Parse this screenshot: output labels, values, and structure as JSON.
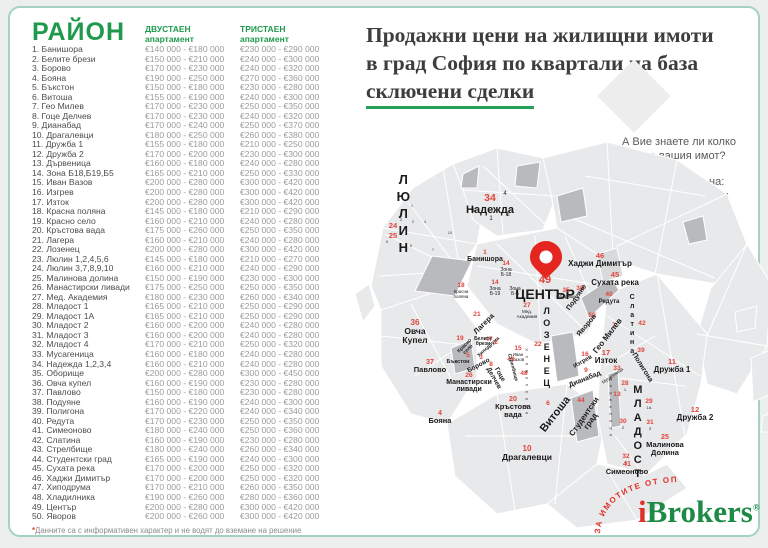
{
  "header": {
    "title_line1": "Продажни цени на жилищни имоти",
    "title_line2": "в град София по квартали на база",
    "title_line3": "сключени сделки"
  },
  "promo": {
    "line1": "А Вие знаете ли колко",
    "line2": "струва вашия имот?",
    "line3": "Разберете СЕГА на:",
    "email": "popitai@ibrokers.bg"
  },
  "table": {
    "header": {
      "district": "РАЙОН",
      "col2_line1": "ДВУСТАЕН",
      "col2_line2": "апартамент",
      "col3_line1": "ТРИСТАЕН",
      "col3_line2": "апартамент"
    },
    "rows": [
      [
        "1. Банишора",
        "€140 000 - €180 000",
        "€230 000 - €290 000"
      ],
      [
        "2. Белите брези",
        "€150 000 - €210 000",
        "€240 000 - €300 000"
      ],
      [
        "3. Борово",
        "€170 000 - €230 000",
        "€240 000 - €320 000"
      ],
      [
        "4. Бояна",
        "€190 000 - €250 000",
        "€270 000 - €360 000"
      ],
      [
        "5. Бъкстон",
        "€150 000 - €180 000",
        "€230 000 - €280 000"
      ],
      [
        "6. Витоша",
        "€155 000 - €190 000",
        "€240 000 - €300 000"
      ],
      [
        "7. Гео Милев",
        "€170 000 - €230 000",
        "€250 000 - €350 000"
      ],
      [
        "8. Гоце Делчев",
        "€170 000 - €230 000",
        "€240 000 - €320 000"
      ],
      [
        "9. Дианабад",
        "€170 000 - €240 000",
        "€250 000 - €370 000"
      ],
      [
        "10. Драгалевци",
        "€180 000 - €250 000",
        "€260 000 - €380 000"
      ],
      [
        "11. Дружба 1",
        "€155 000 - €180 000",
        "€210 000 - €250 000"
      ],
      [
        "12. Дружба 2",
        "€170 000 - €200 000",
        "€230 000 - €300 000"
      ],
      [
        "13. Дървеница",
        "€160 000 - €180 000",
        "€240 000 - €280 000"
      ],
      [
        "14. Зона Б18,Б19,Б5",
        "€165 000 - €210 000",
        "€250 000 - €330 000"
      ],
      [
        "15. Иван Вазов",
        "€200 000 - €280 000",
        "€300 000 - €420 000"
      ],
      [
        "16. Изгрев",
        "€200 000 - €280 000",
        "€300 000 - €420 000"
      ],
      [
        "17. Изток",
        "€200 000 - €280 000",
        "€300 000 - €420 000"
      ],
      [
        "18. Красна поляна",
        "€145 000 - €180 000",
        "€210 000 - €290 000"
      ],
      [
        "19. Красно село",
        "€160 000 - €210 000",
        "€240 000 - €280 000"
      ],
      [
        "20. Кръстова вада",
        "€175 000 - €260 000",
        "€250 000 - €350 000"
      ],
      [
        "21. Лагера",
        "€160 000 - €210 000",
        "€240 000 - €280 000"
      ],
      [
        "22. Лозенец",
        "€200 000 - €280 000",
        "€300 000 - €420 000"
      ],
      [
        "23. Люлин 1,2,4,5,6",
        "€145 000 - €180 000",
        "€210 000 - €270 000"
      ],
      [
        "24. Люлин 3,7,8,9,10",
        "€160 000 - €210 000",
        "€240 000 - €290 000"
      ],
      [
        "25. Малинова долина",
        "€150 000 - €190 000",
        "€230 000 - €300 000"
      ],
      [
        "26. Манастирски ливади",
        "€175 000 - €250 000",
        "€250 000 - €350 000"
      ],
      [
        "27. Мед. Академия",
        "€180 000 - €230 000",
        "€260 000 - €340 000"
      ],
      [
        "28. Младост 1",
        "€165 000 - €210 000",
        "€250 000 - €290 000"
      ],
      [
        "29. Младост 1А",
        "€165 000 - €210 000",
        "€250 000 - €290 000"
      ],
      [
        "30. Младост 2",
        "€160 000 - €200 000",
        "€240 000 - €280 000"
      ],
      [
        "31. Младост 3",
        "€160 000 - €200 000",
        "€240 000 - €280 000"
      ],
      [
        "32. Младост 4",
        "€170 000 - €210 000",
        "€250 000 - €320 000"
      ],
      [
        "33. Мусагеница",
        "€160 000 - €180 000",
        "€240 000 - €280 000"
      ],
      [
        "34. Надежда 1,2,3,4",
        "€160 000 - €210 000",
        "€240 000 - €280 000"
      ],
      [
        "35. Оборище",
        "€200 000 - €280 000",
        "€300 000 - €450 000"
      ],
      [
        "36. Овча купел",
        "€160 000 - €190 000",
        "€230 000 - €280 000"
      ],
      [
        "37. Павлово",
        "€150 000 - €180 000",
        "€230 000 - €280 000"
      ],
      [
        "38. Подуяне",
        "€160 000 - €190 000",
        "€240 000 - €300 000"
      ],
      [
        "39. Полигона",
        "€170 000 - €220 000",
        "€240 000 - €340 000"
      ],
      [
        "40. Редута",
        "€170 000 - €230 000",
        "€250 000 - €350 000"
      ],
      [
        "41. Симеоново",
        "€180 000 - €240 000",
        "€250 000 - €360 000"
      ],
      [
        "42. Слатина",
        "€160 000 - €190 000",
        "€230 000 - €280 000"
      ],
      [
        "43. Стрелбище",
        "€180 000 - €240 000",
        "€260 000 - €340 000"
      ],
      [
        "44. Студентски град",
        "€165 000 - €190 000",
        "€240 000 - €300 000"
      ],
      [
        "45. Сухата река",
        "€170 000 - €200 000",
        "€250 000 - €320 000"
      ],
      [
        "46. Хаджи Димитър",
        "€170 000 - €200 000",
        "€250 000 - €320 000"
      ],
      [
        "47. Хиподрума",
        "€170 000 - €210 000",
        "€260 000 - €350 000"
      ],
      [
        "48. Хладилника",
        "€190 000 - €260 000",
        "€280 000 - €360 000"
      ],
      [
        "49. Център",
        "€200 000 - €280 000",
        "€300 000 - €420 000"
      ],
      [
        "50. Яворов",
        "€200 000 - €260 000",
        "€300 000 - €420 000"
      ]
    ],
    "footnote_star": "*",
    "footnote": "Данните са с информативен характер и не водят до вземане на решение"
  },
  "map": {
    "labels": [
      {
        "t": "ЛЮЛИН",
        "x": 48,
        "y": 36,
        "s": 13,
        "b": 1,
        "v": 1
      },
      {
        "n": "24",
        "x": 38,
        "y": 86,
        "s": 8
      },
      {
        "n": "25",
        "x": 38,
        "y": 96,
        "s": 8
      },
      {
        "t": "1",
        "x": 57,
        "y": 68,
        "s": 4,
        "c": "#444444"
      },
      {
        "t": "3",
        "x": 46,
        "y": 82,
        "s": 4,
        "c": "#444444"
      },
      {
        "t": "2",
        "x": 58,
        "y": 84,
        "s": 4,
        "c": "#444444"
      },
      {
        "t": "4",
        "x": 70,
        "y": 84,
        "s": 4,
        "c": "#444444"
      },
      {
        "t": "5",
        "x": 32,
        "y": 104,
        "s": 4,
        "c": "#444444"
      },
      {
        "t": "6",
        "x": 56,
        "y": 108,
        "s": 4,
        "c": "#444444"
      },
      {
        "t": "7",
        "x": 78,
        "y": 112,
        "s": 4,
        "c": "#444444"
      },
      {
        "t": "10",
        "x": 95,
        "y": 95,
        "s": 4,
        "c": "#444444"
      },
      {
        "n": "34",
        "t": "Надежда",
        "x": 135,
        "y": 58,
        "s": 11,
        "b": 1
      },
      {
        "t": "4",
        "x": 150,
        "y": 55,
        "s": 6
      },
      {
        "t": "3",
        "x": 118,
        "y": 72,
        "s": 6
      },
      {
        "t": "1",
        "x": 136,
        "y": 80,
        "s": 6
      },
      {
        "t": "2",
        "x": 153,
        "y": 76,
        "s": 6
      },
      {
        "n": "1",
        "t": "Банишора",
        "x": 130,
        "y": 113,
        "s": 7,
        "b": 1
      },
      {
        "n": "14",
        "t": "Зона\nБ-18",
        "x": 151,
        "y": 125,
        "s": 5
      },
      {
        "n": "14",
        "t": "Зона\nБ-19",
        "x": 140,
        "y": 144,
        "s": 5
      },
      {
        "t": "Зона\nБ-5",
        "x": 160,
        "y": 151,
        "s": 5
      },
      {
        "n": "18",
        "t": "Красна\nполяна",
        "x": 106,
        "y": 147,
        "s": 4.5
      },
      {
        "n": "49",
        "t": "ЦЕНТЪР",
        "x": 190,
        "y": 139,
        "s": 14,
        "b": 1,
        "ns": 11
      },
      {
        "n": "35",
        "t": "Оборище",
        "x": 211,
        "y": 152,
        "s": 4.5
      },
      {
        "n": "38",
        "x": 225,
        "y": 149,
        "s": 7
      },
      {
        "t": "Подуяне",
        "x": 222,
        "y": 158,
        "s": 7,
        "b": 1,
        "r": -55
      },
      {
        "n": "46",
        "t": "Хаджи Димитър",
        "x": 245,
        "y": 116,
        "s": 8,
        "b": 1
      },
      {
        "n": "45",
        "t": "Сухата река",
        "x": 260,
        "y": 135,
        "s": 8,
        "b": 1
      },
      {
        "n": "40",
        "t": "Редута",
        "x": 254,
        "y": 156,
        "s": 6,
        "b": 1
      },
      {
        "t": "Слатина",
        "x": 277,
        "y": 158,
        "s": 7,
        "b": 1,
        "v": 1
      },
      {
        "n": "42",
        "x": 287,
        "y": 184,
        "s": 7
      },
      {
        "n": "50",
        "x": 237,
        "y": 176,
        "s": 7
      },
      {
        "t": "Яворов",
        "x": 232,
        "y": 186,
        "s": 7,
        "b": 1,
        "r": -50
      },
      {
        "n": "7",
        "x": 259,
        "y": 186,
        "s": 7
      },
      {
        "t": "Гео Милев",
        "x": 253,
        "y": 196,
        "s": 8,
        "b": 1,
        "r": -52
      },
      {
        "n": "27",
        "t": "Мед.\nАкадемия",
        "x": 172,
        "y": 167,
        "s": 4.5
      },
      {
        "n": "21",
        "x": 122,
        "y": 175,
        "s": 7
      },
      {
        "t": "Лагера",
        "x": 129,
        "y": 184,
        "s": 7.5,
        "b": 1,
        "r": -45
      },
      {
        "n": "47",
        "x": 134,
        "y": 201,
        "s": 6
      },
      {
        "t": "Хиподрума",
        "x": 134,
        "y": 209,
        "s": 5,
        "b": 1,
        "r": -42
      },
      {
        "n": "15",
        "t": "Иван\nВазов",
        "x": 163,
        "y": 210,
        "s": 4.5
      },
      {
        "n": "2",
        "x": 141,
        "y": 204,
        "s": 6
      },
      {
        "t": "Белите\nбрези",
        "x": 128,
        "y": 201,
        "s": 5,
        "b": 1
      },
      {
        "n": "19",
        "x": 105,
        "y": 200,
        "s": 6
      },
      {
        "t": "Красно\nсело",
        "x": 112,
        "y": 207,
        "s": 5,
        "b": 1,
        "r": -45
      },
      {
        "n": "43",
        "x": 156,
        "y": 221,
        "s": 6
      },
      {
        "t": "Стрелбище",
        "x": 157,
        "y": 229,
        "s": 5,
        "b": 1,
        "r": 75
      },
      {
        "n": "5",
        "x": 113,
        "y": 217,
        "s": 6
      },
      {
        "t": "Бъкстон",
        "x": 103,
        "y": 224,
        "s": 5.5,
        "b": 1
      },
      {
        "n": "3",
        "x": 126,
        "y": 219,
        "s": 6
      },
      {
        "t": "Борово",
        "x": 124,
        "y": 227,
        "s": 6.5,
        "b": 1,
        "r": -28
      },
      {
        "n": "8",
        "x": 136,
        "y": 226,
        "s": 6
      },
      {
        "t": "Гоце\nДелчев",
        "x": 141,
        "y": 234,
        "s": 6.5,
        "b": 1,
        "r": 60
      },
      {
        "n": "37",
        "t": "Павлово",
        "x": 75,
        "y": 223,
        "s": 7.5,
        "b": 1
      },
      {
        "n": "26",
        "t": "Манастирски\nливади",
        "x": 114,
        "y": 236,
        "s": 7,
        "b": 1
      },
      {
        "n": "36",
        "t": "Овча\nКупел",
        "x": 60,
        "y": 183,
        "s": 8.5,
        "b": 1
      },
      {
        "n": "4",
        "t": "Бояна",
        "x": 85,
        "y": 274,
        "s": 7.5,
        "b": 1
      },
      {
        "n": "20",
        "t": "Кръстова\nвада",
        "x": 158,
        "y": 260,
        "s": 7.5,
        "b": 1
      },
      {
        "n": "48",
        "x": 169,
        "y": 235,
        "s": 6
      },
      {
        "t": "Хладилника",
        "x": 171,
        "y": 211,
        "s": 4,
        "v": 1
      },
      {
        "n": "22",
        "x": 183,
        "y": 205,
        "s": 7
      },
      {
        "t": "ЛОЗЕНЕЦ",
        "x": 191,
        "y": 170,
        "s": 9,
        "b": 1,
        "v": 1
      },
      {
        "n": "6",
        "x": 193,
        "y": 264,
        "s": 7
      },
      {
        "t": "Витоша",
        "x": 201,
        "y": 273,
        "s": 11,
        "b": 1,
        "r": -52
      },
      {
        "n": "44",
        "x": 226,
        "y": 261,
        "s": 7
      },
      {
        "t": "Студентски\nград",
        "x": 233,
        "y": 275,
        "s": 8,
        "b": 1,
        "r": -55
      },
      {
        "n": "9",
        "x": 231,
        "y": 231,
        "s": 7
      },
      {
        "t": "Дианабад",
        "x": 230,
        "y": 240,
        "s": 7,
        "b": 1,
        "r": -22
      },
      {
        "n": "33",
        "x": 262,
        "y": 229,
        "s": 7
      },
      {
        "t": "Мусагеница",
        "x": 258,
        "y": 238,
        "s": 4.5,
        "r": -35
      },
      {
        "n": "13",
        "x": 262,
        "y": 255,
        "s": 7
      },
      {
        "t": "Дървеница",
        "x": 255,
        "y": 240,
        "s": 4,
        "v": 1
      },
      {
        "n": "16",
        "x": 230,
        "y": 215,
        "s": 7
      },
      {
        "t": "Изгрев",
        "x": 228,
        "y": 223,
        "s": 6,
        "b": 1,
        "r": -30
      },
      {
        "n": "17",
        "t": "Изток",
        "x": 251,
        "y": 213,
        "s": 8,
        "b": 1
      },
      {
        "n": "39",
        "x": 286,
        "y": 211,
        "s": 7
      },
      {
        "t": "Полигона",
        "x": 287,
        "y": 228,
        "s": 7,
        "b": 1,
        "r": 58
      },
      {
        "n": "11",
        "t": "Дружба 1",
        "x": 317,
        "y": 222,
        "s": 8,
        "b": 1
      },
      {
        "n": "12",
        "t": "Дружба 2",
        "x": 340,
        "y": 270,
        "s": 8,
        "b": 1
      },
      {
        "t": "МЛАДОСТ",
        "x": 282,
        "y": 248,
        "s": 11,
        "b": 1,
        "v": 1
      },
      {
        "n": "28",
        "t": "1",
        "x": 270,
        "y": 245,
        "s": 4
      },
      {
        "n": "29",
        "t": "1А",
        "x": 294,
        "y": 263,
        "s": 4
      },
      {
        "n": "30",
        "t": "2",
        "x": 268,
        "y": 283,
        "s": 4
      },
      {
        "n": "31",
        "t": "3",
        "x": 295,
        "y": 284,
        "s": 4
      },
      {
        "n": "32",
        "t": "4",
        "x": 271,
        "y": 318,
        "s": 4
      },
      {
        "n": "25",
        "t": "Малинова\nДолина",
        "x": 310,
        "y": 298,
        "s": 7.5,
        "b": 1
      },
      {
        "n": "41",
        "t": "Симеоново",
        "x": 272,
        "y": 325,
        "s": 7.5,
        "b": 1
      },
      {
        "n": "10",
        "t": "Драгалевци",
        "x": 172,
        "y": 309,
        "s": 8.5,
        "b": 1
      }
    ]
  },
  "logo": {
    "arc_text": "ЗА ИМОТИТЕ ОТ ОПИТ",
    "i": "i",
    "brokers": "Brokers",
    "reg": "®"
  },
  "colors": {
    "brand_green": "#1f9a4d",
    "underline_green": "#27a05a",
    "label_red": "#e2453b",
    "pin_red": "#e52620",
    "logo_red": "#e03128",
    "logo_green": "#1d8a45",
    "map_base": "#e8e9eb",
    "map_dark": "#b9babd",
    "card_border": "#a5d2bf"
  }
}
